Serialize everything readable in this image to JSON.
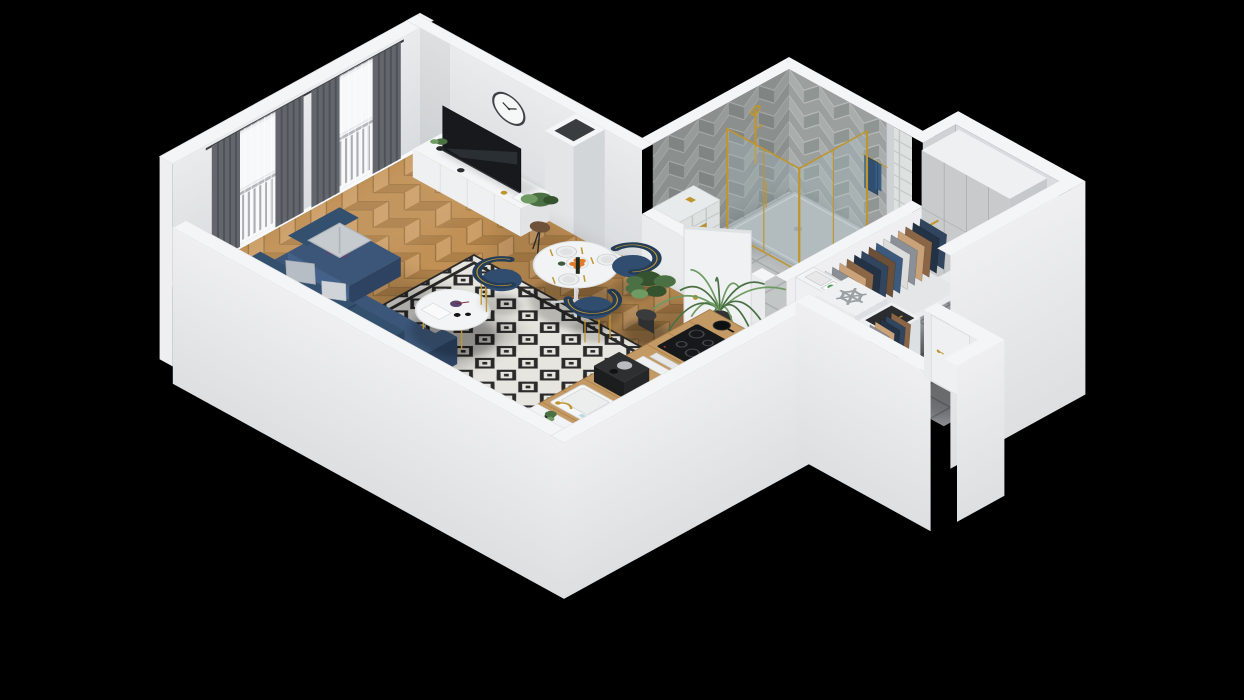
{
  "title": "Isometric 3D render of a studio apartment floor plan",
  "background": "#000000",
  "palette": {
    "bg": "#000000",
    "wallTop": "#f4f5f6",
    "wallFace": "#e9ebec",
    "wallFace2": "#d9dcde",
    "wallShade": "#cfd2d4",
    "wallExt": "#efeff1",
    "wallExt2": "#dddfe1",
    "baseboard": "#f8f9fa",
    "wood": "#c09055",
    "woodLight": "#cd9f68",
    "woodDark": "#ae8049",
    "woodLine": "#96713f",
    "rugBase": "#e7e5df",
    "rugInk": "#2b2b2b",
    "sofa": "#3b5678",
    "sofaDark": "#2d4361",
    "sofaTop": "#44618a",
    "pillowGray": "#b7bdc4",
    "pillowLight": "#d0d4d8",
    "pillowPurple": "#5a4470",
    "blanket": "#c6cbd0",
    "gold": "#bf9530",
    "goldDark": "#9c7a22",
    "tableWhite": "#f2f3f4",
    "lineSoft": "#dfe2e3",
    "chair": "#304c6e",
    "chairDark": "#243d59",
    "tv": "#17191c",
    "tvSheen": "#2e343a",
    "counterWood": "#c49a64",
    "counterLine": "#a87c48",
    "applianceBlack": "#1a1b1d",
    "steel": "#b9bcbe",
    "bathGrout": "#a9adae",
    "bathTile": "#c3c6c7",
    "herrBg": "#9ba09f",
    "herrA": "#a9aeac",
    "herrB": "#8f9593",
    "herrLine": "#c2c6c4",
    "sqLine": "#c2c6c5",
    "sqTile": "#dde1e0",
    "hallLine": "#787c7e",
    "hallTile": "#989c9e",
    "wardrobe": "#d8dadb",
    "wardrobeShade": "#c6c9cb",
    "wardrobeLine": "#b4b7b9",
    "glass": "#a9bfc6",
    "towel": "#2f4e70",
    "towelDark": "#243d59",
    "greenDark": "#35522f",
    "green": "#4a7044",
    "greenLight": "#6f9a62",
    "pot": "#232425",
    "orange": "#e07b28",
    "doorWhite": "#f0f1f2",
    "doorLine": "#d8dadc",
    "clockRim": "#3f4346",
    "clockHand": "#2c2f31",
    "railing": "#55595d",
    "railBar": "#6a6e72",
    "curtain": "#63676d",
    "curtainFold": "#4e5257",
    "sheer": "#f2f4f5",
    "glow": "#fbfcfd",
    "clothes": [
      "#31455e",
      "#243246",
      "#8a6546",
      "#caa27a",
      "#8b9096",
      "#dcdcdc",
      "#3c5a7d",
      "#6b4f37"
    ]
  },
  "scene": {
    "rooms": [
      {
        "name": "living-room",
        "features": [
          "corner-sofa-navy",
          "black-white-diamond-rug",
          "round-coffee-table",
          "tv-sideboard",
          "tv",
          "wall-clock",
          "two-curtained-balcony-windows",
          "balcony-railing",
          "floor-plant",
          "gray-curtains",
          "white-sheers"
        ]
      },
      {
        "name": "dining-nook",
        "features": [
          "round-pedestal-table",
          "three-navy-gold-chairs",
          "plates-and-gold-cutlery",
          "orange-fruit-bowl",
          "bottle",
          "monstera-plant"
        ]
      },
      {
        "name": "kitchen",
        "features": [
          "wood-countertop",
          "white-sink-gold-faucet",
          "coffee-machine",
          "cutting-boards",
          "induction-cooktop",
          "black-pot",
          "corner-cabinet-plant",
          "refrigerator-snowflake-top"
        ]
      },
      {
        "name": "bathroom",
        "features": [
          "herringbone-wall-tiles",
          "square-tile-pony-wall",
          "wall-hung-toilet",
          "gold-flush-plate",
          "gold-frame-glass-shower",
          "gray-shower-tray",
          "gold-shower-column",
          "navy-towel",
          "duct-shaft-column",
          "white-door-ajar"
        ]
      },
      {
        "name": "hallway",
        "features": [
          "gray-tile-floor",
          "full-height-wardrobe",
          "open-clothes-rack-gold-rail",
          "hanging-clothes",
          "white-bookshelf",
          "coat-closet",
          "entry-door-gold-handle"
        ]
      }
    ],
    "icons": [
      {
        "name": "snowflake-icon",
        "meaning": "freezer/refrigerator marker",
        "color": "#9aa0a3"
      },
      {
        "name": "clock-icon",
        "meaning": "analog wall clock",
        "time": "10:08"
      }
    ]
  }
}
